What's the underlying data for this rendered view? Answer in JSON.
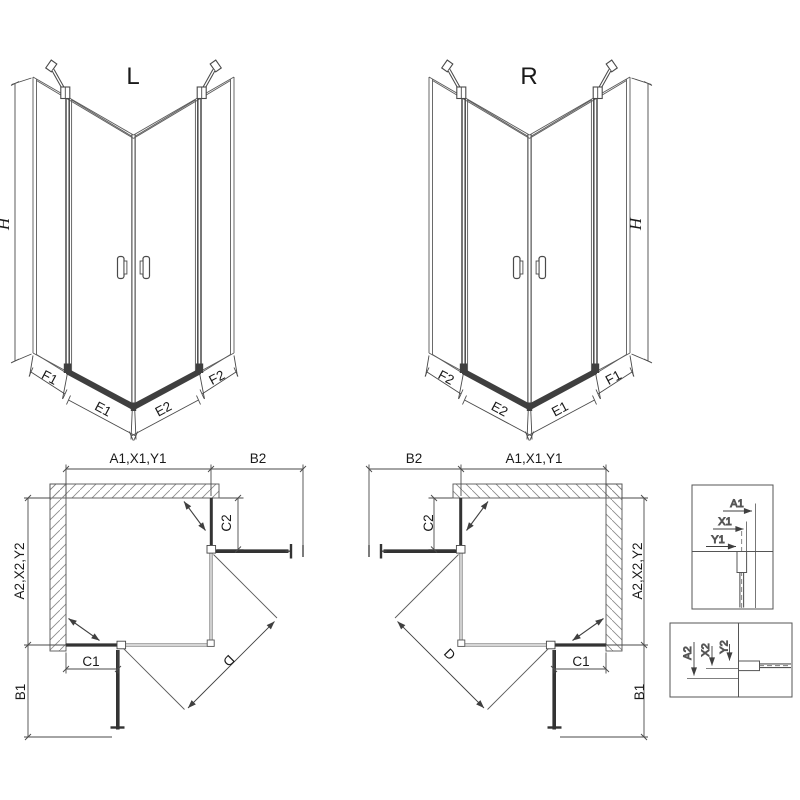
{
  "iso_left": {
    "label": "L",
    "height_label": "H",
    "bottom_labels": [
      "F1",
      "E1",
      "E2",
      "F2"
    ]
  },
  "iso_right": {
    "label": "R",
    "height_label": "H",
    "bottom_labels": [
      "F2",
      "E2",
      "E1",
      "F1"
    ]
  },
  "plan_left": {
    "top_width_label": "A1,X1,Y1",
    "top_reach_label": "B2",
    "side_height_label": "A2,X2,Y2",
    "side_reach_label": "B1",
    "fixed_panel_side_label": "C2",
    "fixed_panel_bottom_label": "C1",
    "diagonal_entry_label": "D"
  },
  "plan_right": {
    "top_width_label": "A1,X1,Y1",
    "top_reach_label": "B2",
    "side_height_label": "A2,X2,Y2",
    "side_reach_label": "B1",
    "fixed_panel_side_label": "C2",
    "fixed_panel_bottom_label": "C1",
    "diagonal_entry_label": "D"
  },
  "detail_top": {
    "labels": [
      "A1",
      "X1",
      "Y1"
    ]
  },
  "detail_bottom": {
    "labels": [
      "A2",
      "X2",
      "Y2"
    ]
  },
  "colors": {
    "line": "#5a5a5a",
    "dark": "#3f3f3f",
    "text": "#1a1a1a",
    "hatch": "#8a8a8a",
    "background": "#ffffff"
  }
}
